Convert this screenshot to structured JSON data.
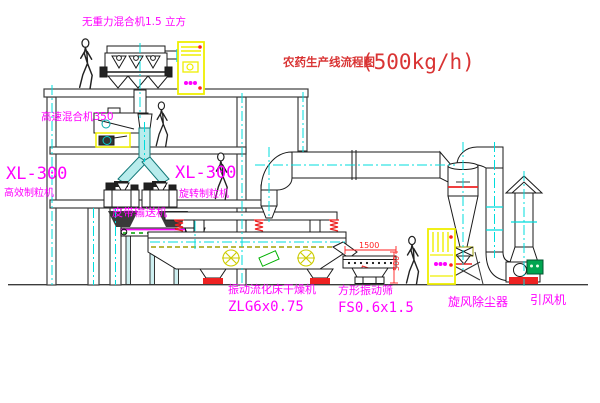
{
  "title": {
    "name_cn": "农药生产线流程图",
    "capacity": "(500kg/h)"
  },
  "labels": {
    "gravityless_mixer": "无重力混合机1.5 立方",
    "high_speed_mixer": "高速混合机350",
    "granulator_left_model": "XL-300",
    "granulator_left_name": "高效制粒机",
    "granulator_right_model": "XL-300",
    "granulator_right_name": "旋转制粒机",
    "belt_conveyor": "皮带输送机",
    "dryer_name": "振动流化床干燥机",
    "dryer_model": "ZLG6x0.75",
    "screen_name": "方形振动筛",
    "screen_model": "FS0.6x1.5",
    "cyclone": "旋风除尘器",
    "fan": "引风机"
  },
  "dims": {
    "screen_length": "1500",
    "screen_height": "500"
  },
  "colors": {
    "label_magenta": "#ff00ff",
    "title_red": "#d93434",
    "dimension_red": "#ff2020",
    "centerline_cyan": "#00dcdc",
    "cabinet_yellow": "#ededed00-note",
    "cabinet_yellow_hex": "#efef00",
    "motor_green": "#00a550",
    "structure_gray": "#3c3c3c"
  }
}
